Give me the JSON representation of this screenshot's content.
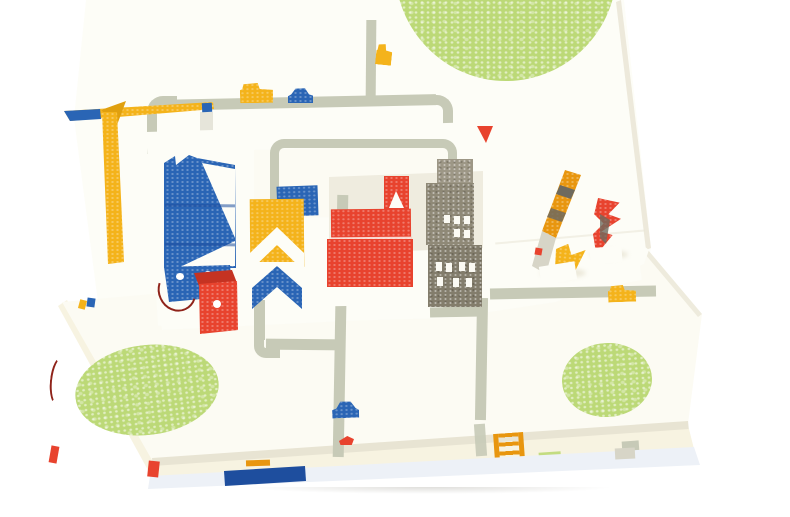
{
  "scene": {
    "type": "photograph",
    "subject": "open pop-up book showing a folded paper city on white pages",
    "background": "seamless white"
  },
  "palette": {
    "background": "#ffffff",
    "page": "#fcfbf3",
    "page_bright": "#fdfdf7",
    "page_shadow": "#e8e4d3",
    "page_cream": "#f7f3e1",
    "cover": "#edf1f7",
    "pit": "#efecdf",
    "road": "#c7cab7",
    "road_soft": "#d7d5c7",
    "green": "#bcd977",
    "yellow": "#f4b31b",
    "yellow_deep": "#e0a00e",
    "orange": "#e8960f",
    "blue": "#2a65b5",
    "blue_deep": "#1e4e9e",
    "red": "#e8432e",
    "red_deep": "#c53322",
    "gray_building_light": "#9d9786",
    "gray_building": "#8f8977",
    "gray_building_dark": "#837d6c",
    "band_dark": "#6e6a5e",
    "wire": "#8f231a"
  },
  "objects": {
    "back_page": "standing page with street loop and park circle",
    "flat_page": "flat page with streets and two park circles",
    "parks": [
      "top-right green circle",
      "bottom-left green circle",
      "bottom-right green circle"
    ],
    "buildings": [
      "yellow paper crane",
      "blue tower with white diagonals and notched top",
      "blue base block with white dots",
      "red cube with white dot",
      "yellow chevron house with blue chevron base",
      "small blue block",
      "small yellow chevron column",
      "red hall with white-gabled tower",
      "gray high-rise with white windows"
    ],
    "vehicles": [
      "yellow truck on top street",
      "blue car on top street",
      "small yellow truck at vertical street",
      "yellow car on right street",
      "blue car on bottom street",
      "small red car on bottom street"
    ],
    "extras": [
      "half-folded paper pop-ups on right page",
      "red binding thread at left edge",
      "orange ladder print on inner page edge",
      "blue stripe on cover fore-edge"
    ]
  }
}
